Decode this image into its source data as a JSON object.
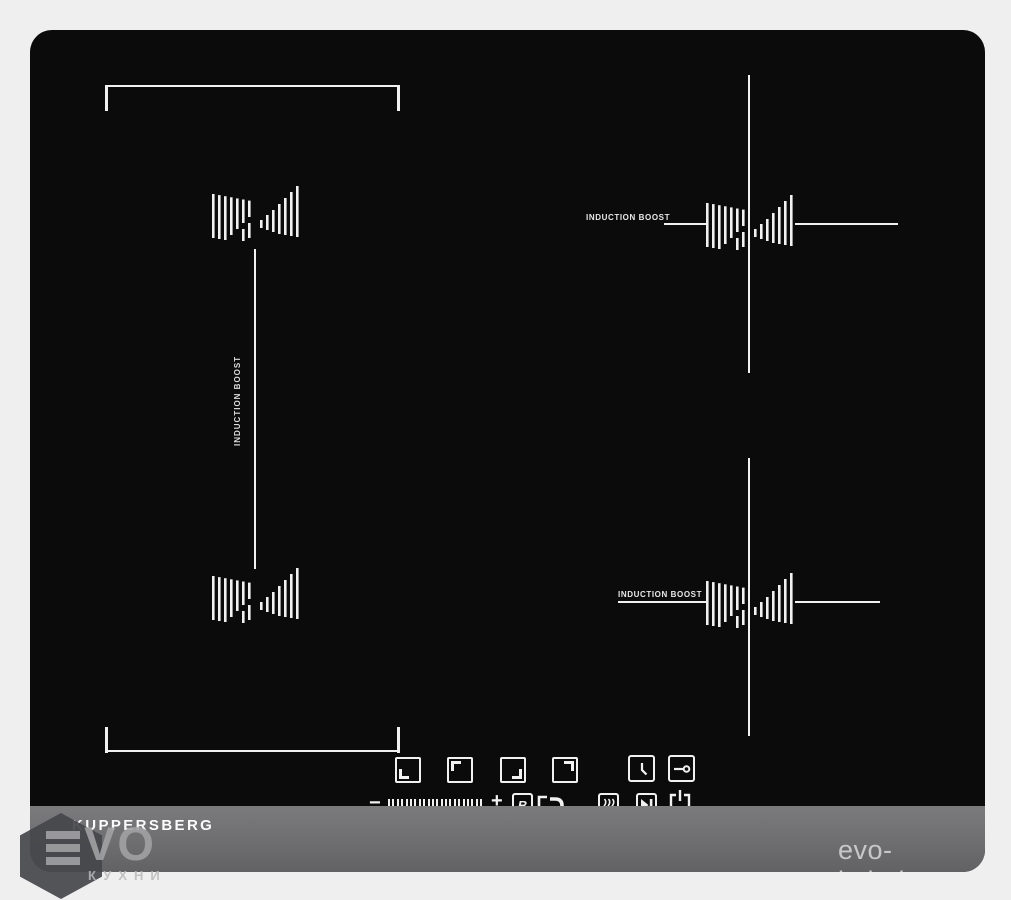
{
  "product": {
    "brand_logo": "KUPPERSBERG",
    "zone_left": {
      "boost_label": "INDUCTION BOOST"
    },
    "zone_right_top": {
      "boost_label": "INDUCTION BOOST"
    },
    "zone_right_bottom": {
      "boost_label": "INDUCTION BOOST"
    },
    "controls": {
      "minus_label": "−",
      "plus_label": "+",
      "boost_key_label": "B"
    }
  },
  "watermark": {
    "brand_full": "EVO",
    "brand_display": "VO",
    "caption": "КУХНИ",
    "site_url": "evo-kuhni.ru"
  },
  "colors": {
    "page_bg": "#efeff0",
    "glass": "#0b0b0c",
    "bezel": "#6e6e70",
    "marking": "#f1f1f1",
    "watermark_gray": "#a3a3a5",
    "site_text": "#c7c7c9"
  }
}
